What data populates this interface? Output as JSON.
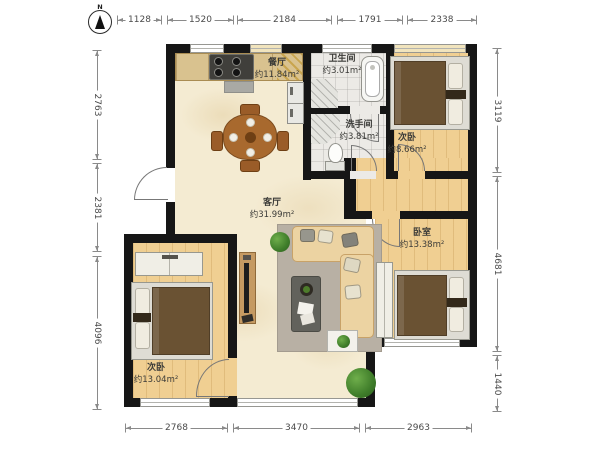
{
  "compass": {
    "label": "N"
  },
  "dimensions": {
    "top": [
      "1128",
      "1520",
      "2184",
      "1791",
      "2338"
    ],
    "left": [
      "2763",
      "2381",
      "4096"
    ],
    "right": [
      "3119",
      "4681",
      "1440"
    ],
    "bottom": [
      "2768",
      "3470",
      "2963"
    ]
  },
  "rooms": {
    "dining": {
      "name": "餐厅",
      "area": "约11.84m²"
    },
    "bathroom": {
      "name": "卫生间",
      "area": "约3.01m²"
    },
    "washroom": {
      "name": "洗手间",
      "area": "约3.81m²"
    },
    "bedroom_top_right": {
      "name": "次卧",
      "area": "约8.66m²"
    },
    "living": {
      "name": "客厅",
      "area": "约31.99m²"
    },
    "bedroom_right": {
      "name": "卧室",
      "area": "约13.38m²"
    },
    "bedroom_bottom_left": {
      "name": "次卧",
      "area": "约13.04m²"
    }
  },
  "colors": {
    "wall": "#161616",
    "wood_floor": "#f0cf92",
    "marble_floor": "#f4ebd2",
    "tile_floor": "#eceae6",
    "bed_blanket": "#6a5233",
    "sofa": "#ecd3a2"
  }
}
